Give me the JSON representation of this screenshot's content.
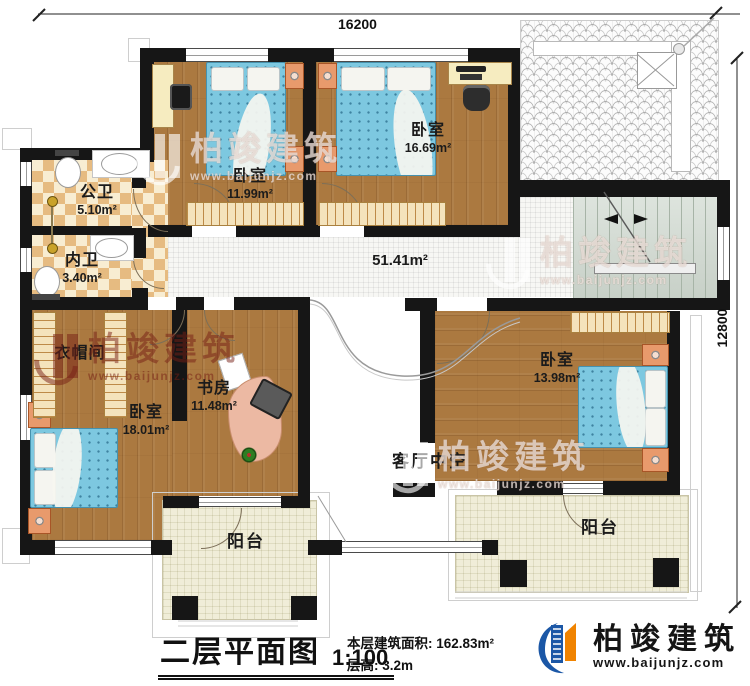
{
  "plan": {
    "dimensions": {
      "top": "16200",
      "right": "12800"
    },
    "rooms": [
      {
        "name": "公卫",
        "area": "5.10m²"
      },
      {
        "name": "内卫",
        "area": "3.40m²"
      },
      {
        "name": "卧室",
        "area": "11.99m²"
      },
      {
        "name": "卧室",
        "area": "16.69m²"
      },
      {
        "area": "51.41m²"
      },
      {
        "name": "衣帽间"
      },
      {
        "name": "卧室",
        "area": "18.01m²"
      },
      {
        "name": "书房",
        "area": "11.48m²"
      },
      {
        "name": "卧室",
        "area": "13.98m²"
      },
      {
        "name": "客厅中空"
      },
      {
        "name": "阳台"
      },
      {
        "name": "阳台"
      }
    ]
  },
  "footer": {
    "title": "二层平面图",
    "scale": "1:100",
    "floor_area_label": "本层建筑面积:",
    "floor_area_value": "162.83m²",
    "floor_height_label": "层高:",
    "floor_height_value": "3.2m"
  },
  "brand": {
    "name": "柏竣建筑",
    "website": "www.baijunjz.com"
  },
  "watermark": {
    "name": "柏竣建筑",
    "website": "www.baijunjz.com"
  },
  "colors": {
    "wall": "#161616",
    "wood_floor": "#ab7940",
    "bed_blue": "#7dc8e0",
    "checker_dark": "#e6bb81",
    "checker_light": "#f8edd2",
    "corridor_tile": "#f7f7f4",
    "balcony_tile": "#f0edd8",
    "stairs": "#d2dbd2",
    "brand_blue": "#1b57a6",
    "brand_orange": "#f08300"
  }
}
